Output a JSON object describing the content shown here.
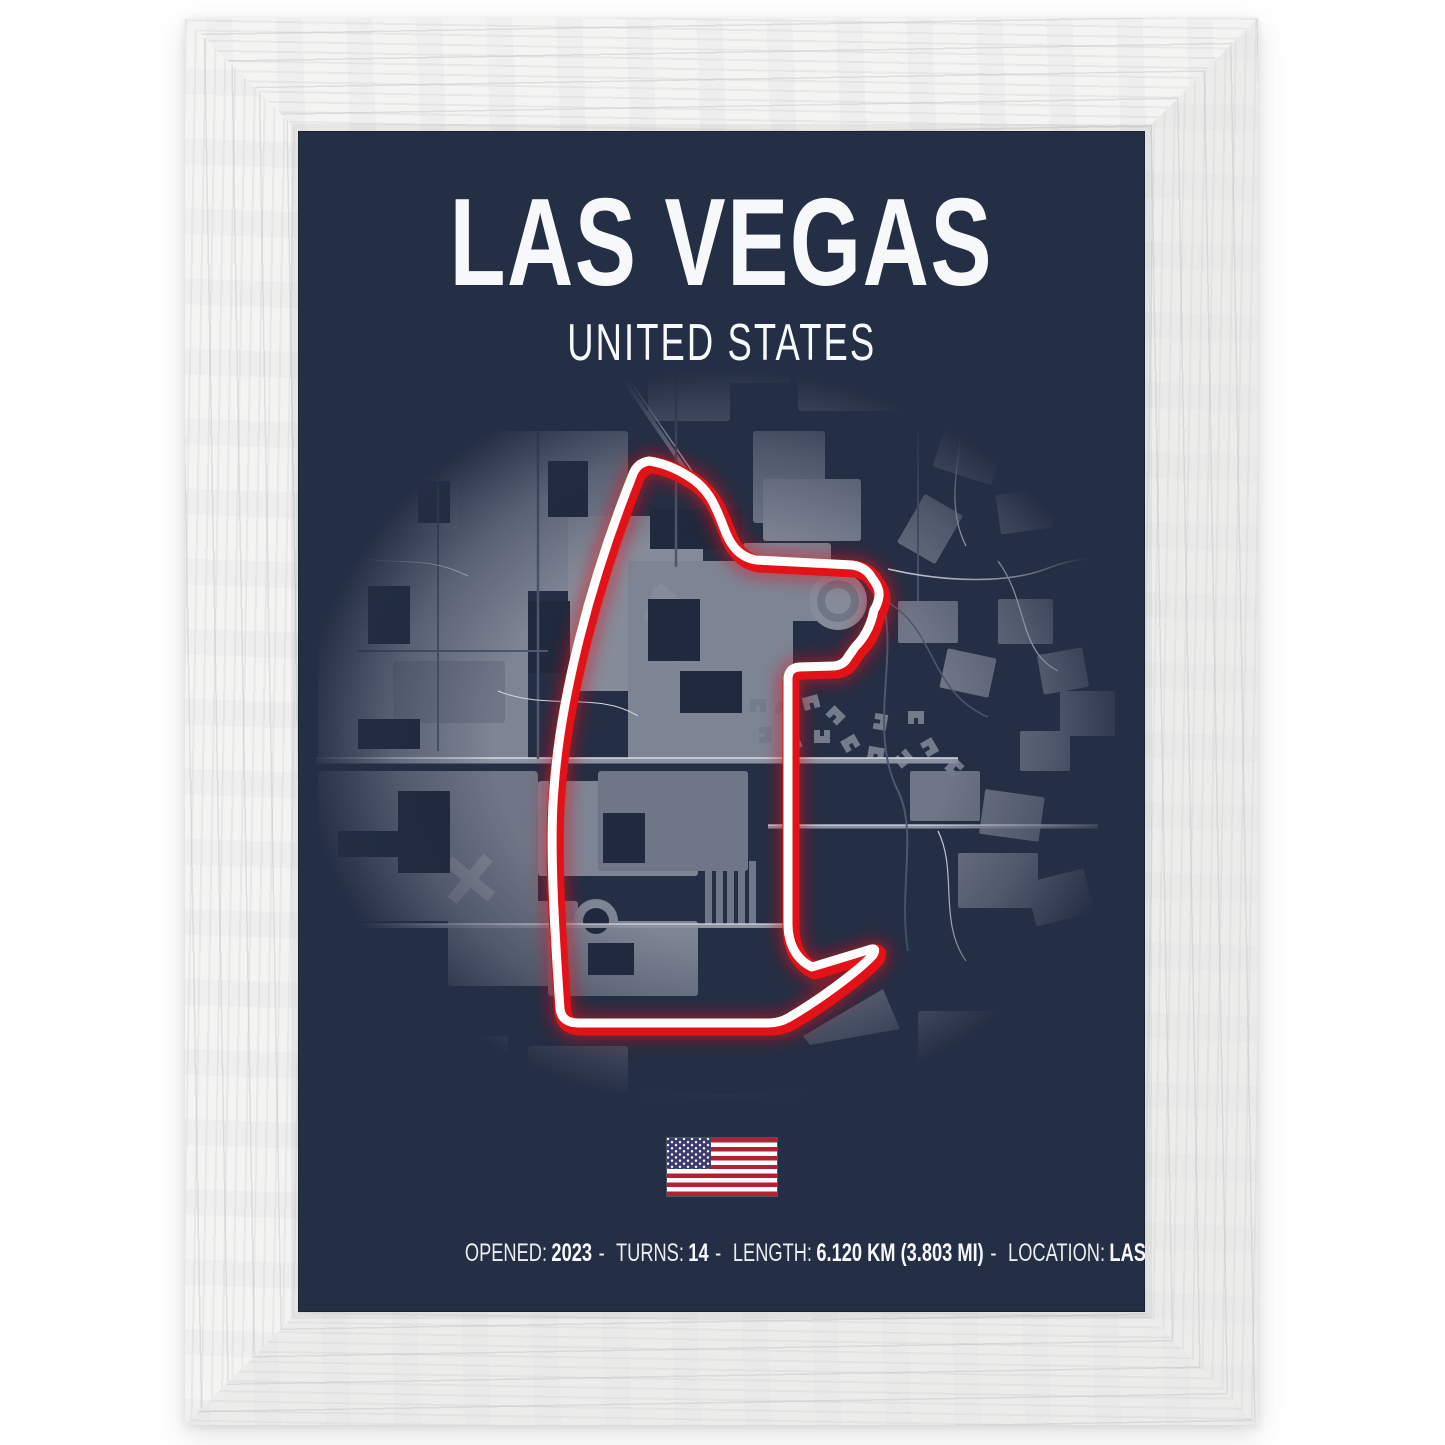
{
  "poster": {
    "title": "LAS VEGAS",
    "subtitle": "UNITED STATES",
    "stats": {
      "separator": "-",
      "items": [
        {
          "label": "OPENED:",
          "value": "2023"
        },
        {
          "label": "TURNS:",
          "value": "14"
        },
        {
          "label": "LENGTH:",
          "value": "6.120 KM (3.803 MI)"
        },
        {
          "label": "LOCATION:",
          "value": "LAS VEGAS, UNITED STATES"
        }
      ]
    }
  },
  "map": {
    "circuit": {
      "path_d": "M265,882 C260,810 254,718 259,662 C265,576 292,462 338,347 Q342,336 354,334 Q374,337 393,349 C413,361 420,377 429,401 C435,418 444,430 461,433 L557,438 Q571,440 577,451 Q585,461 584,469 Q583,477 579,483 C576,499 569,511 560,520 L553,530 Q549,538 539,539 L504,540 Q494,541 493,551 L493,797 C493,815 500,832 517,840 L573,823 Q583,819 578,828 C562,845 524,873 493,891 Q484,896 473,896 L283,896 Q267,896 265,882 Z"
    }
  },
  "colors": {
    "page_bg": "#ffffff",
    "frame_base": "#f1f1ef",
    "navy": "#242e44",
    "map_cut": "#20293d",
    "map_gray": "#7d8494",
    "map_gray2": "#6f7687",
    "map_gray3": "#868b99",
    "road_light": "#d6dae2",
    "road_mid": "#8b92a2",
    "road_faint": "#4d5870",
    "red": "#e31118",
    "track_white": "#ffffff",
    "text_white": "#f7f8fa",
    "flag_red": "#b22234",
    "flag_blue": "#3c3b6e"
  }
}
